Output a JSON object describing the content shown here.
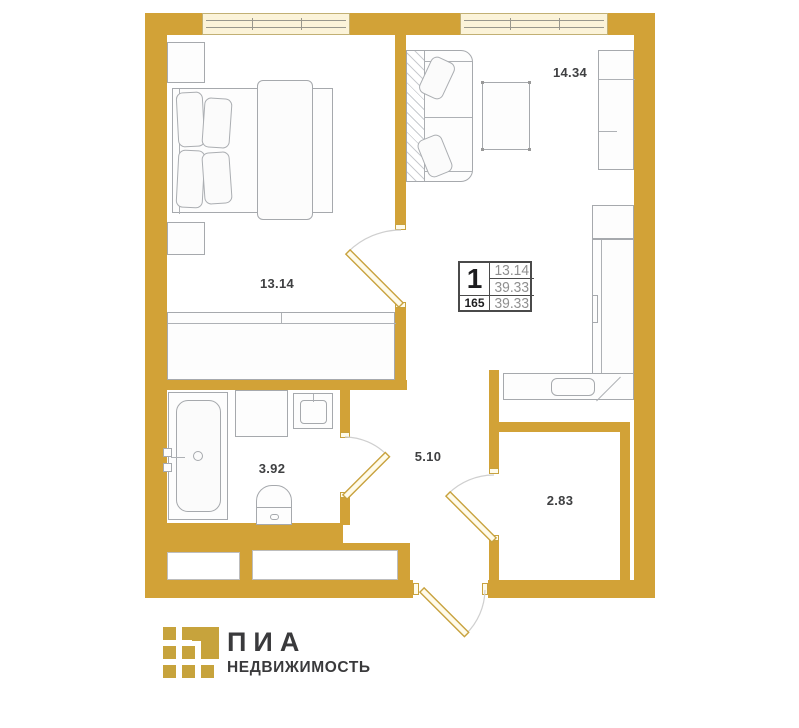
{
  "plan": {
    "unit": {
      "rooms_count": "1",
      "living_area": "13.14",
      "total_area": "39.33",
      "unit_number": "165",
      "total_area_repeat": "39.33"
    },
    "rooms": [
      {
        "name": "bedroom",
        "area": "13.14"
      },
      {
        "name": "living-kitchen",
        "area": "14.34"
      },
      {
        "name": "bathroom",
        "area": "3.92"
      },
      {
        "name": "hallway",
        "area": "5.10"
      },
      {
        "name": "wardrobe-room",
        "area": "2.83"
      }
    ]
  },
  "branding": {
    "title": "ПИА",
    "subtitle": "НЕДВИЖИМОСТЬ"
  },
  "colors": {
    "wall": "#D2A237",
    "window_fill": "#FBF3D9",
    "logo_gold": "#C7A33C"
  }
}
